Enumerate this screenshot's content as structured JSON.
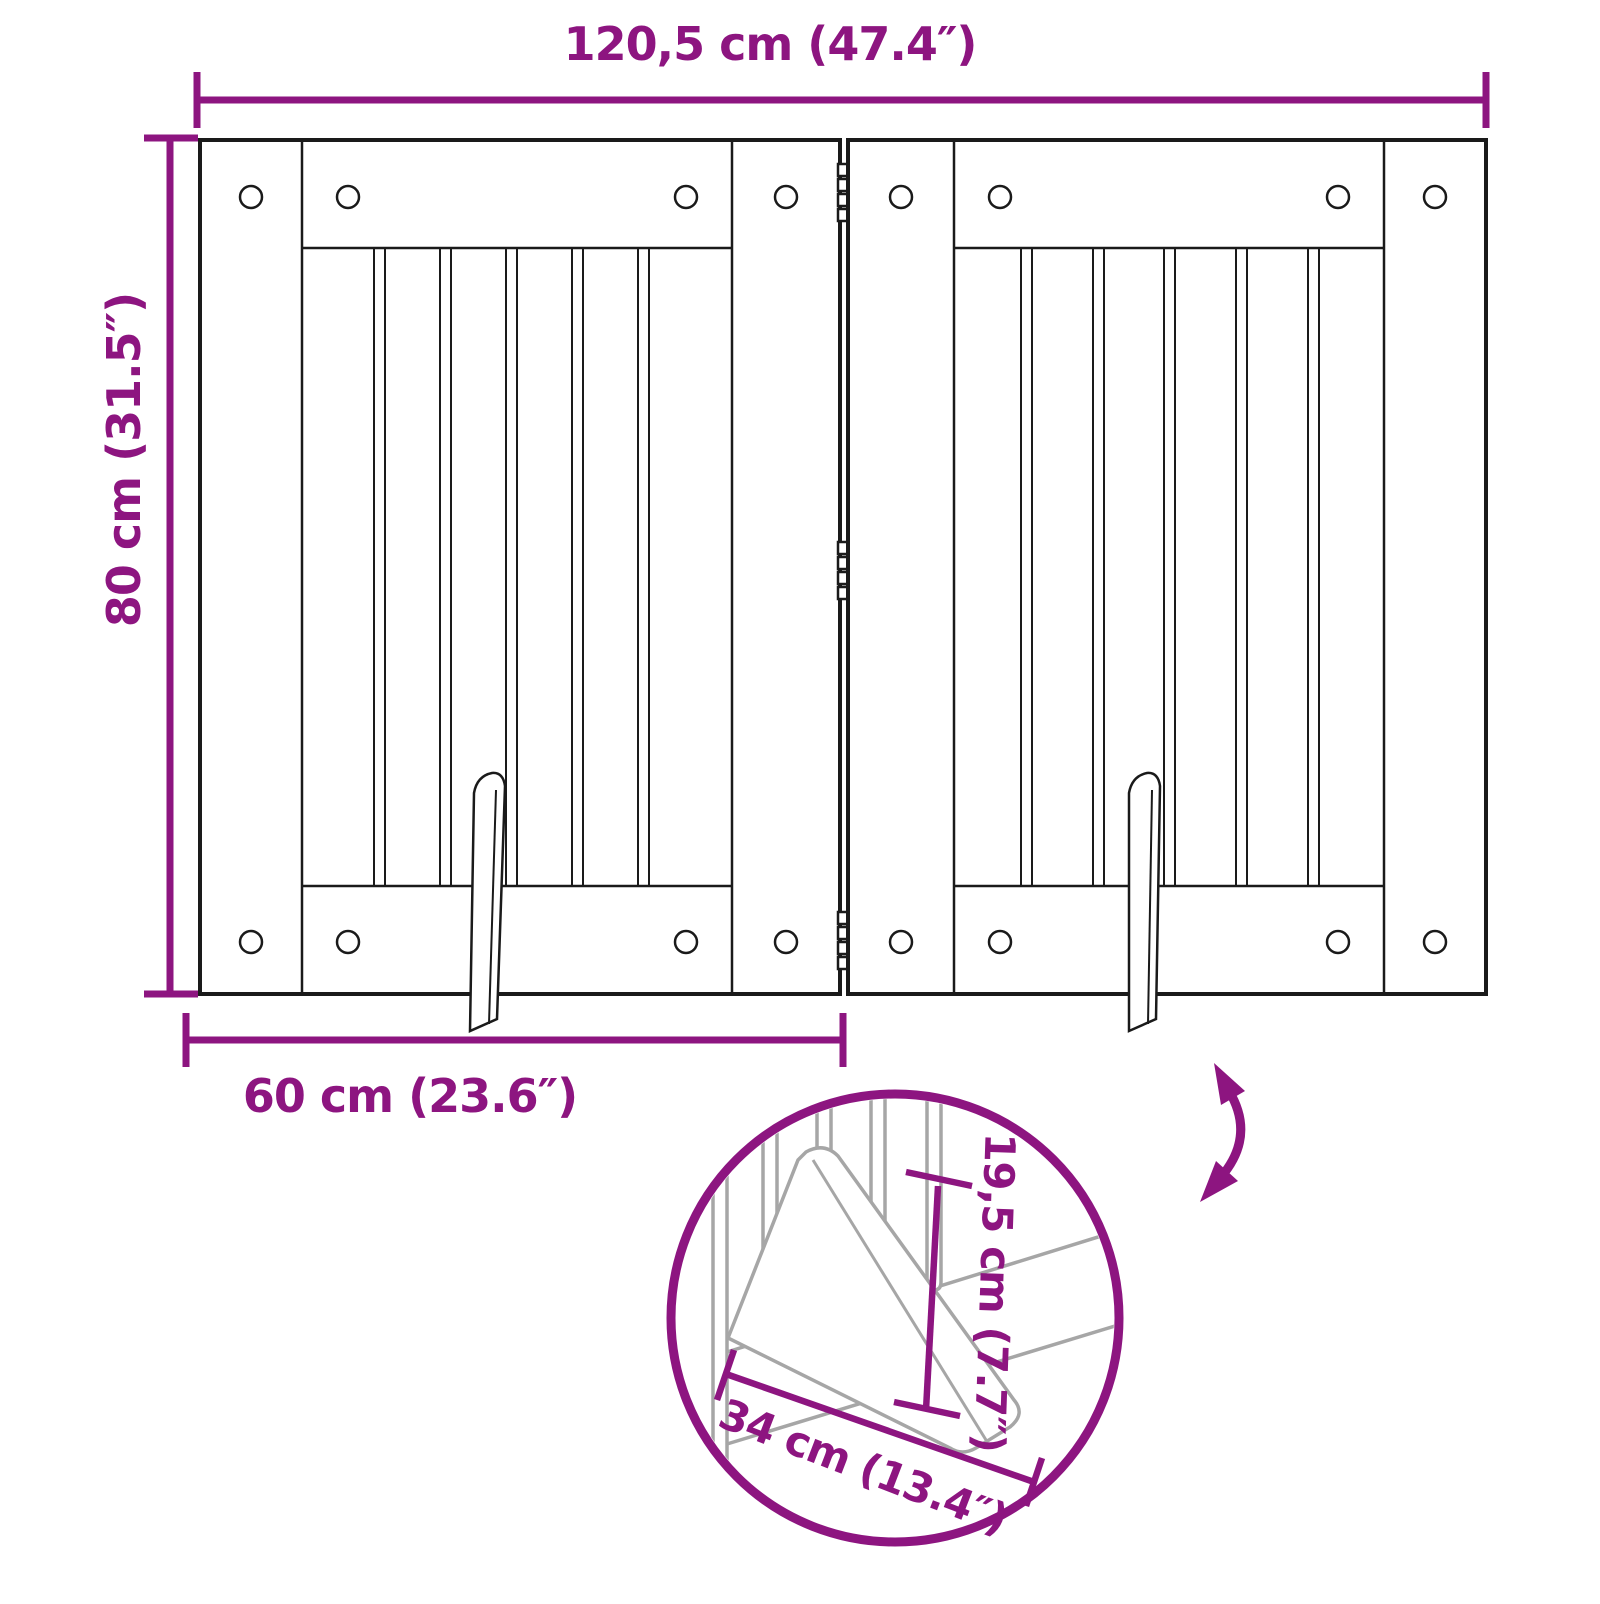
{
  "title": "Foldable pet gate dimension diagram",
  "colors": {
    "accent_purple": "#8d1580",
    "drawing_line": "#1a1a1a",
    "detail_line_gray": "#a6a6a6",
    "background": "#ffffff"
  },
  "dimensions": {
    "total_width": "120,5 cm (47.4″)",
    "total_height": "80 cm (31.5″)",
    "panel_width": "60 cm (23.6″)",
    "foot_length": "34 cm (13.4″)",
    "foot_height": "19,5 cm (7.7″)"
  },
  "figure": {
    "panels": 2,
    "slats_per_panel": 5,
    "hinges": 3,
    "screws_per_panel": 8,
    "support_feet": 2
  },
  "icons": {
    "fold_arrow": "curved-double-arrow-icon"
  }
}
